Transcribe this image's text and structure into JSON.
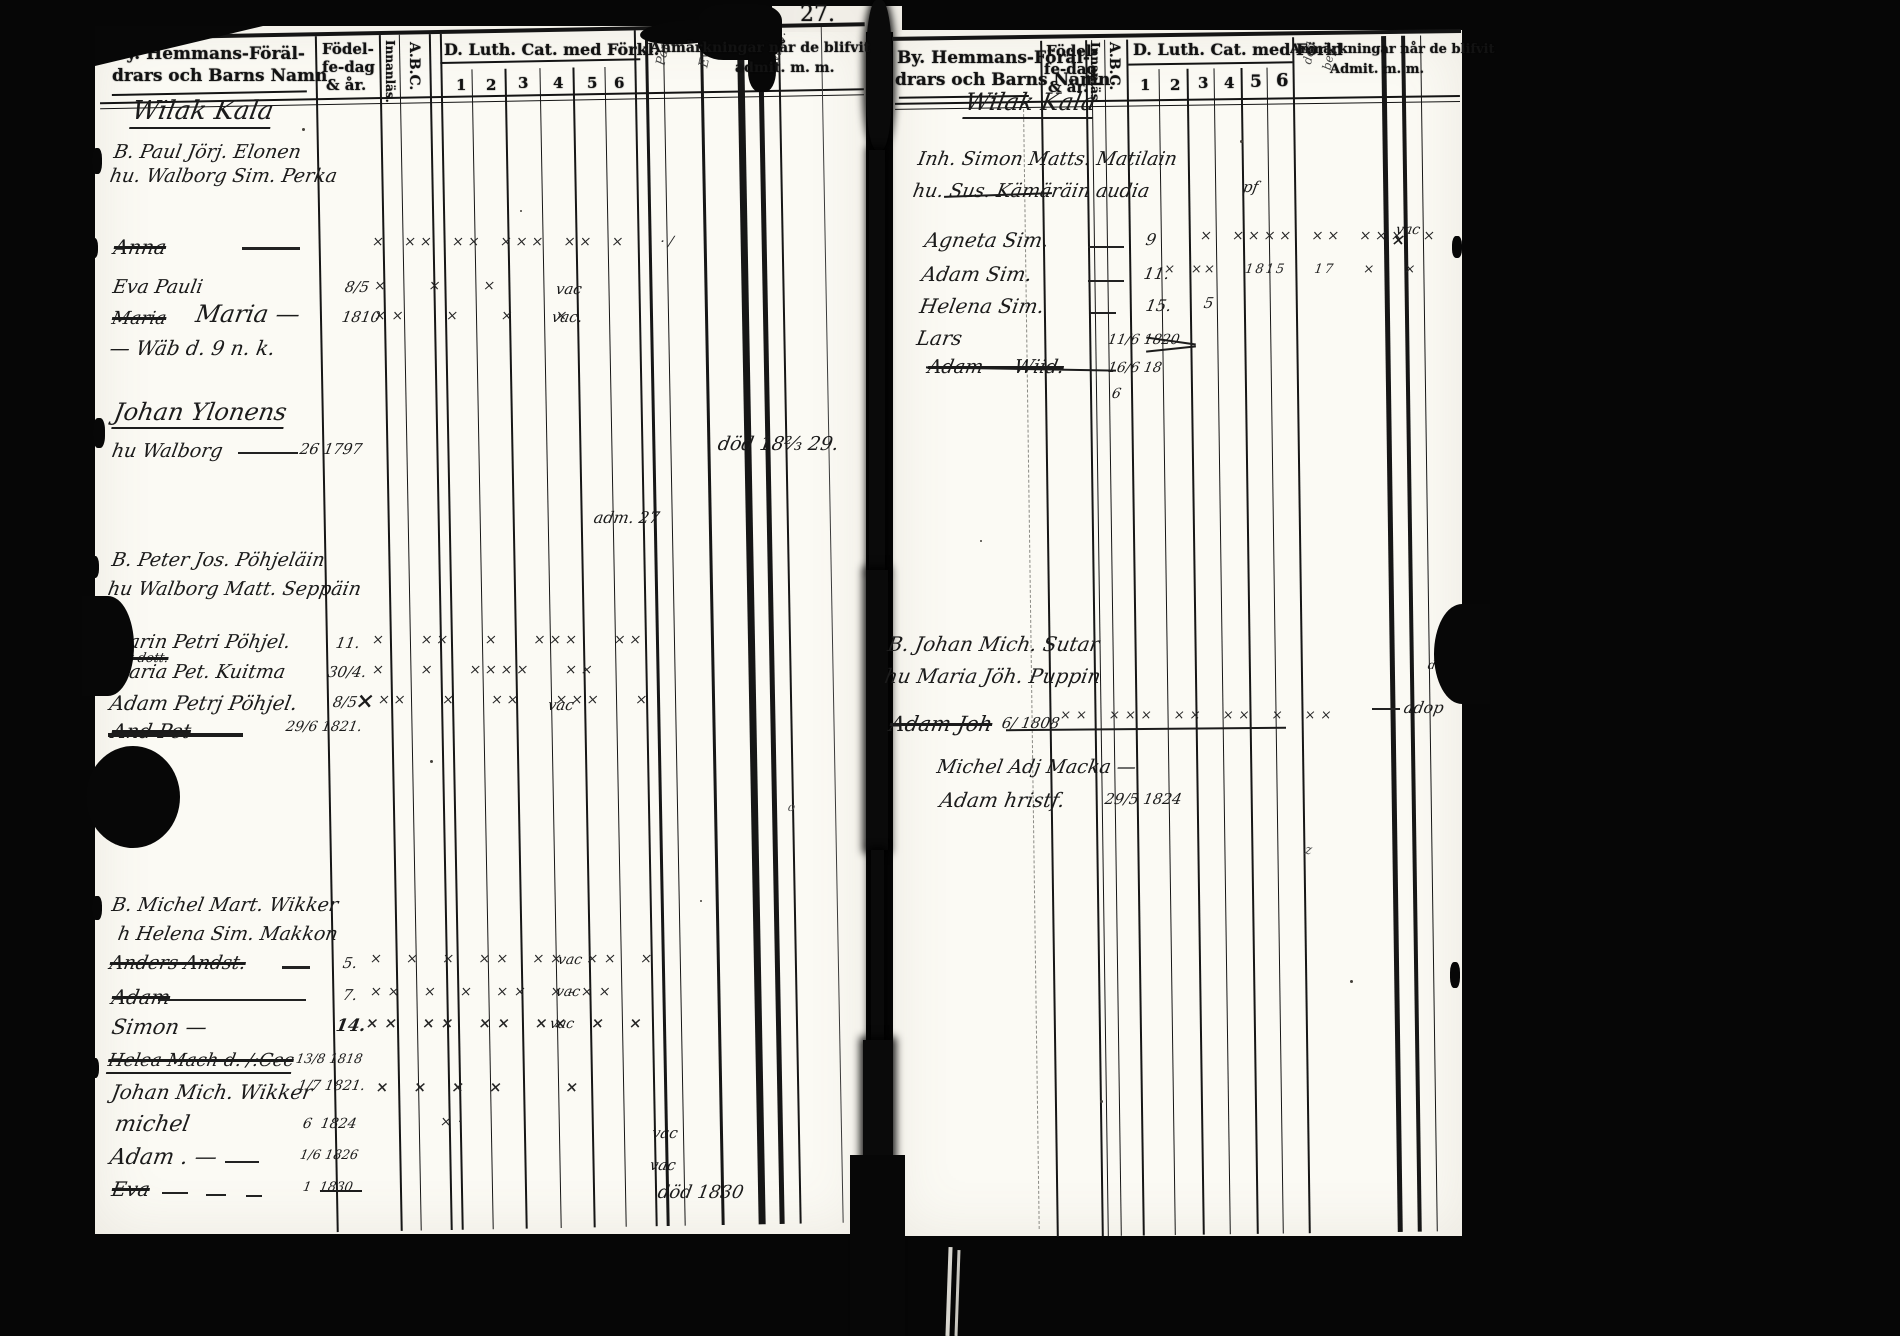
{
  "meta": {
    "page_number": "27."
  },
  "hdr_left": {
    "name1": "By. Hemmans-Föräl-",
    "name2": "drars och Barns Namn",
    "b1": "Födel-",
    "b2": "fe-dag",
    "b3": "& år.",
    "innan": "Innanläs.",
    "abc": "A.B.C.",
    "cat": "D. Luth. Cat. med Förkl.",
    "cols": [
      "1",
      "2",
      "3",
      "4",
      "5",
      "6"
    ],
    "rem1": "Anmärkningar når de blifvit",
    "rem2": "admit. m. m."
  },
  "hdr_right": {
    "name1": "By. Hemmans-Föräl-",
    "name2": "drars och Barns Namn.",
    "b1": "Födel-",
    "b2": "fe-dag",
    "b3": "& år.",
    "innan": "Innanläs.",
    "abc": "A.B.C.",
    "cat": "D. Luth. Cat. med Förkl",
    "cols": [
      "1",
      "2",
      "3",
      "4",
      "5",
      "6"
    ],
    "rem1": "Anmärkningar når de blifvit",
    "rem2": "Admit. m. m."
  },
  "left": {
    "village": "Wilak Kala",
    "vert": [
      "Pauli",
      "Eva",
      "Walb."
    ],
    "f1h": "B. Paul Jörj. Elonen",
    "f1w": "hu. Walborg Sim. Perka",
    "f1c1": "Anna",
    "f1c1_marks": "× ×× ×× ××× ×× ×  ·/",
    "f1c2": "Eva Pauli",
    "f1c2_birth": "8/5",
    "f1c2_marks": "×  ×  ×",
    "f1c2_rem": "vac",
    "f1c3_old": "Maria",
    "f1c3": "Maria —",
    "f1c3_birth": "1810",
    "f1c3_marks": "××  ×  ×  ×",
    "f1c3_rem": "vac.",
    "f1c4": "— Wäb d. 9 n. k.",
    "f2h": "Johan Ylonens",
    "f2w": "hu Walborg",
    "f2w_birth": "26 1797",
    "f2w_rem": "död 18⅔ 29.",
    "stray_rem": "adm. 27",
    "f3h": "B. Peter Jos. Pöhjeläin",
    "f3w": "hu Walborg Matt. Seppäin",
    "f3c1": "Carin Petri Pöhjel.",
    "f3c1_sub": "dt dott.",
    "f3c1_birth": "11.",
    "f3c1_marks": "×  ××  ×  ×××  ××",
    "f3c2": "Maria Pet. Kuitma",
    "f3c2_birth": "30/4.",
    "f3c2_marks": "×  ×  ××××  ××",
    "f3c3": "Adam Petrj Pöhjel.",
    "f3c3_birth": "8/5",
    "f3c3_abc": "×",
    "f3c3_marks": "××  ×  ××  ×××  ×",
    "f3c3_rem": "vac",
    "f3c4": "And Pet",
    "f3c4_birth": "29/6 1821.",
    "f4h": "B. Michel Mart. Wikker",
    "f4w": "h Helena Sim. Makkon",
    "f4c1": "Anders Andst.",
    "f4c1_birth": "5.",
    "f4c1_marks": "× × × ×× ×× ×× ×",
    "f4c1_rem": "vac",
    "f4c2": "Adam",
    "f4c2_birth": "7.",
    "f4c2_marks": "×× × × ×× ×–××",
    "f4c2_rem": "vac",
    "f4c3": "Simon —",
    "f4c3_birth": "14.",
    "f4c3_abc": "××",
    "f4c3_marks": "×× ×× ×× ×× × ×",
    "f4c3_rem": "vac",
    "f4c4": "Helea Mach d. /:Cec",
    "f4c4_birth": "13/8 1818",
    "f4c5": "Johan Mich. Wikker",
    "f4c5_birth": "1/7 1821.",
    "f4c5_marks": "× × × ×   ×",
    "f4c6": "michel",
    "f4c6_birth": "6  1824",
    "f4c6_marks": "×·",
    "f4c6_rem": "vac",
    "f4c7": "Adam . —",
    "f4c7_birth": "1/6 1826",
    "f4c7_rem": "vac",
    "f4c8": "Eva",
    "f4c8_birth": "1  1830",
    "f4c8_rem": "död 1830",
    "stray_o": "o"
  },
  "right": {
    "village": "Wilak Kala",
    "vert": [
      "död",
      "beg."
    ],
    "f1h": "Inh. Simon Matts. Matilain",
    "f1h_rem": "pf",
    "f1w": "hu. Sus. Kämäräin audia",
    "c1": "Agneta Sim.",
    "c1_birth": "9",
    "c1_marks": "× ×××× ×× ××× ×",
    "c1_far": "×",
    "c2": "Adam Sim.",
    "c2_birth": "11.",
    "c2_marks": "× ××  1815  17  ×  ×",
    "c2_rem": "vac",
    "c3": "Helena Sim.",
    "c3_birth": "15.",
    "c3_mark": "5",
    "c4": "Lars",
    "c4_birth": "11/6 1820",
    "c5": "Adam — Wiid.",
    "c5_birth": "16/6 18",
    "c5_birth2": "6",
    "f2h": "B. Johan Mich. Sutar",
    "f2w": "hu Maria Jöh. Puppin",
    "f2c1": "Adam Joh",
    "f2c1_birth": "6/ 1808",
    "f2c1_marks": "×× ××× ×× ×× × ××",
    "f2c1_rem": "adop",
    "f2c1_rem2": "do.",
    "f3h": "Michel Adj Macka —",
    "f3c1": "Adam hristf.",
    "f3c1_birth": "29/5 1824",
    "scribble": "z"
  }
}
